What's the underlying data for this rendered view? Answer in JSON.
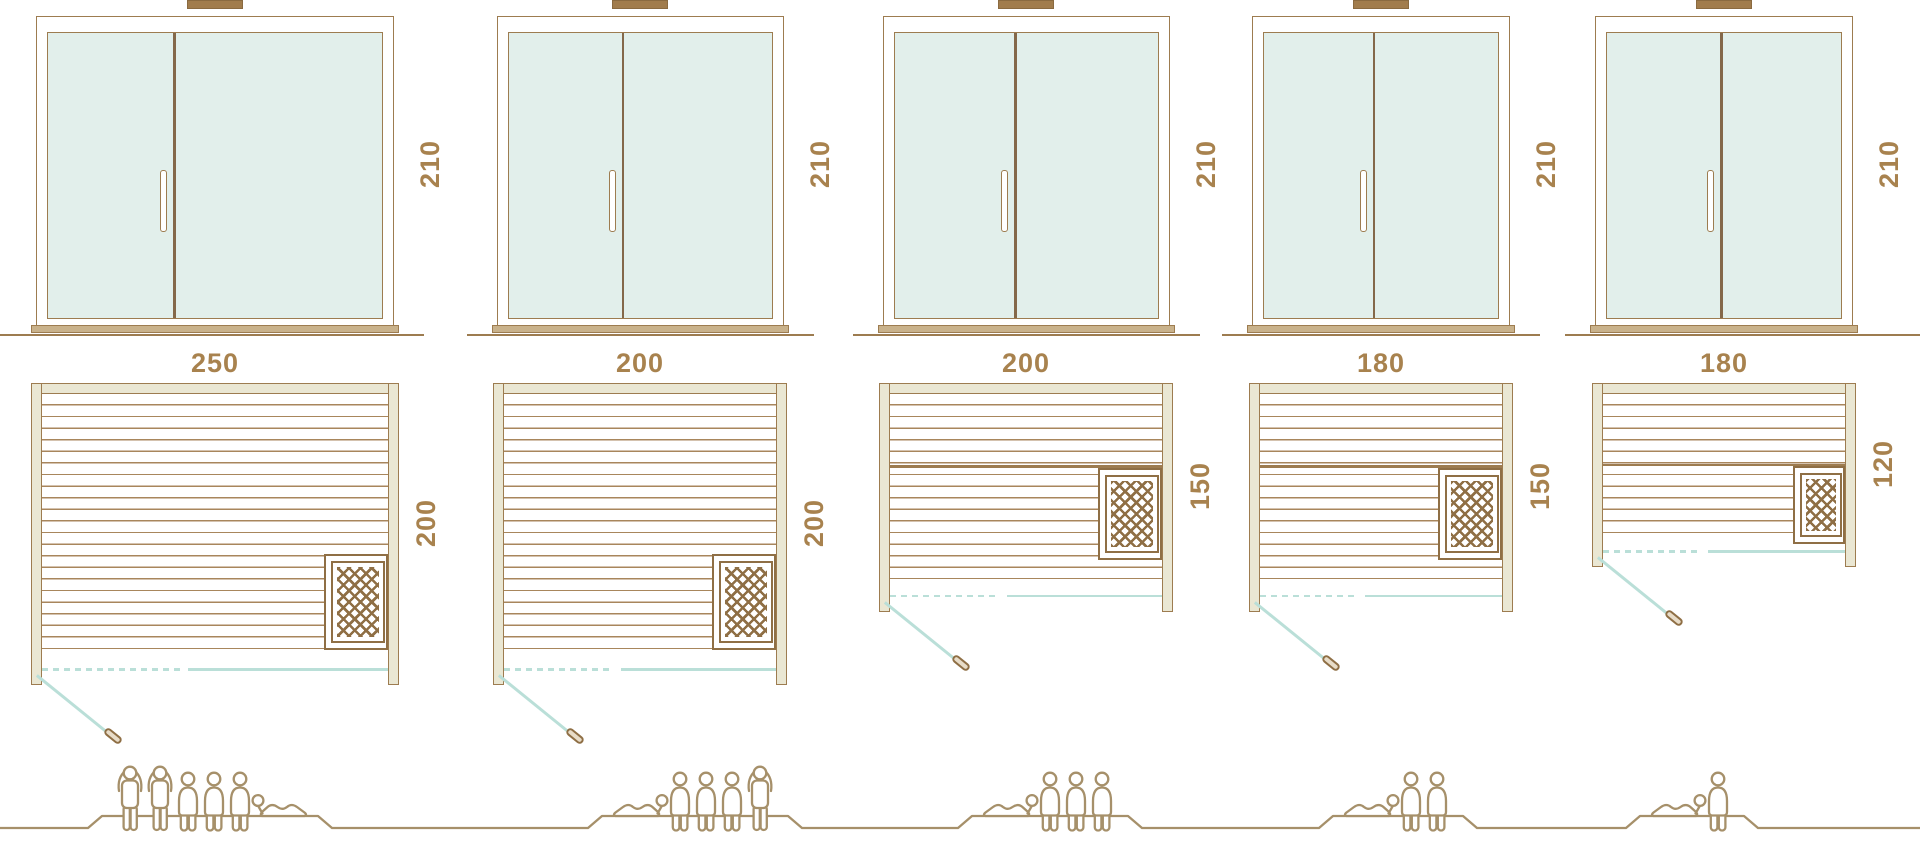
{
  "diagram": {
    "kind": "sauna size comparison",
    "units": "cm",
    "view_top": "front elevation with double glass doors",
    "view_bottom": "floor plan with benches, heater and door swing"
  },
  "colors": {
    "line": "#9D7C50",
    "plank": "#A8865C",
    "beige": "#EAE7D3",
    "glass": "#E2EFEB",
    "teal": "#BADFD8",
    "label": "#A8824E",
    "bar": "#A17C4C",
    "bar_dark": "#8A6A40",
    "mesh": "#8F6F45",
    "people": "#A6906A",
    "sill": "#C9B28B",
    "divider": "#84684A"
  },
  "saunas": [
    {
      "name": "sauna-250x200",
      "width_label": "250",
      "height_label": "210",
      "depth_label": "200",
      "width_cm": 250,
      "height_cm": 210,
      "depth_cm": 200,
      "capacity": 6,
      "heater_position": "front-right",
      "people": [
        "standing",
        "standing",
        "sitting",
        "sitting",
        "sitting",
        "lying-flipped"
      ]
    },
    {
      "name": "sauna-200x200",
      "width_label": "200",
      "height_label": "210",
      "depth_label": "200",
      "width_cm": 200,
      "height_cm": 210,
      "depth_cm": 200,
      "capacity": 5,
      "heater_position": "front-right",
      "people": [
        "lying",
        "sitting",
        "sitting",
        "sitting",
        "standing"
      ]
    },
    {
      "name": "sauna-200x150",
      "width_label": "200",
      "height_label": "210",
      "depth_label": "150",
      "width_cm": 200,
      "height_cm": 210,
      "depth_cm": 150,
      "capacity": 4,
      "heater_position": "side-middle",
      "people": [
        "lying",
        "sitting",
        "sitting",
        "sitting"
      ]
    },
    {
      "name": "sauna-180x150",
      "width_label": "180",
      "height_label": "210",
      "depth_label": "150",
      "width_cm": 180,
      "height_cm": 210,
      "depth_cm": 150,
      "capacity": 3,
      "heater_position": "side-middle",
      "people": [
        "lying",
        "sitting",
        "sitting"
      ]
    },
    {
      "name": "sauna-180x120",
      "width_label": "180",
      "height_label": "210",
      "depth_label": "120",
      "width_cm": 180,
      "height_cm": 210,
      "depth_cm": 120,
      "capacity": 2,
      "heater_position": "side-bottom",
      "people": [
        "lying",
        "sitting"
      ]
    }
  ]
}
